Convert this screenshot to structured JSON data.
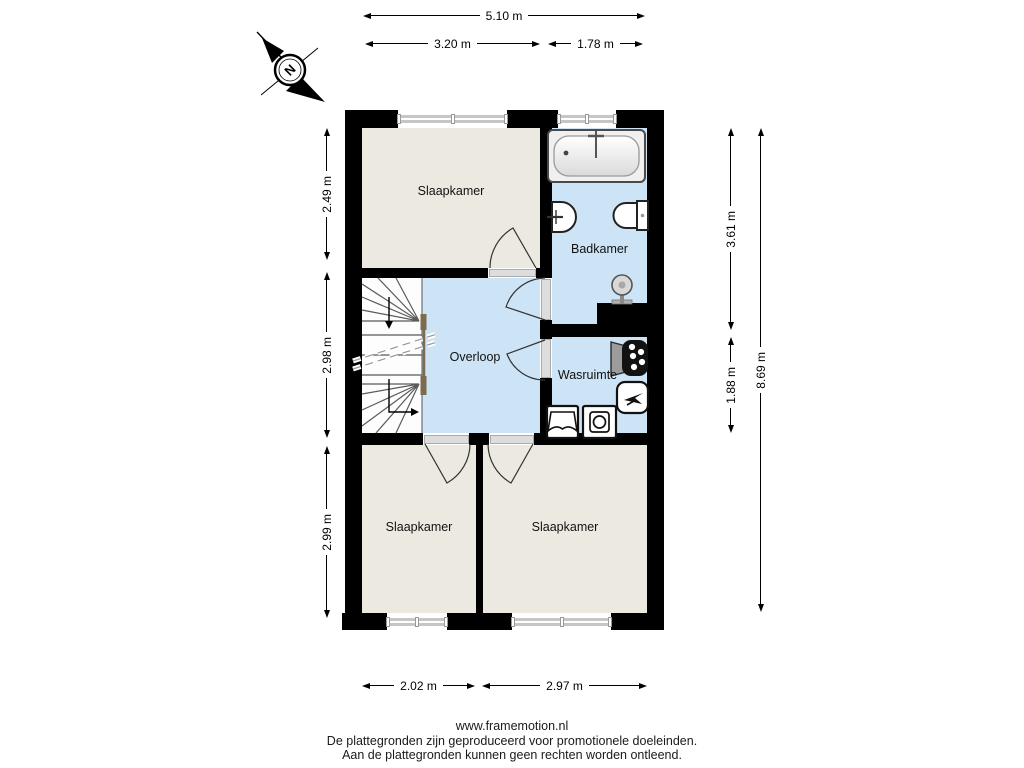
{
  "compass": {
    "label": "N"
  },
  "rooms": [
    {
      "id": "slaapkamer-top",
      "label": "Slaapkamer"
    },
    {
      "id": "badkamer",
      "label": "Badkamer"
    },
    {
      "id": "overloop",
      "label": "Overloop"
    },
    {
      "id": "wasruimte",
      "label": "Wasruimte"
    },
    {
      "id": "slaapkamer-bottom-left",
      "label": "Slaapkamer"
    },
    {
      "id": "slaapkamer-bottom-right",
      "label": "Slaapkamer"
    }
  ],
  "dimensions": {
    "top_total": "5.10 m",
    "top_left": "3.20 m",
    "top_right": "1.78 m",
    "left": [
      "2.49 m",
      "2.98 m",
      "2.99 m"
    ],
    "right": [
      "3.61 m",
      "1.88 m"
    ],
    "right_total": "8.69 m",
    "bottom": [
      "2.02 m",
      "2.97 m"
    ]
  },
  "fixtures": [
    "compass-north",
    "bathtub",
    "sink",
    "toilet",
    "shower",
    "boiler",
    "mechanical-ventilation",
    "laundry-sink",
    "washing-machine",
    "staircase"
  ],
  "footer": {
    "website": "www.framemotion.nl",
    "line1": "De plattegronden zijn geproduceerd voor promotionele doeleinden.",
    "line2": "Aan de plattegronden kunnen geen rechten worden ontleend."
  },
  "colors": {
    "wall": "#000000",
    "floor_room": "#ECEAE0",
    "floor_wet": "#CDE4F6",
    "window": "#C6C6C6",
    "rail": "#7D6B4F"
  }
}
